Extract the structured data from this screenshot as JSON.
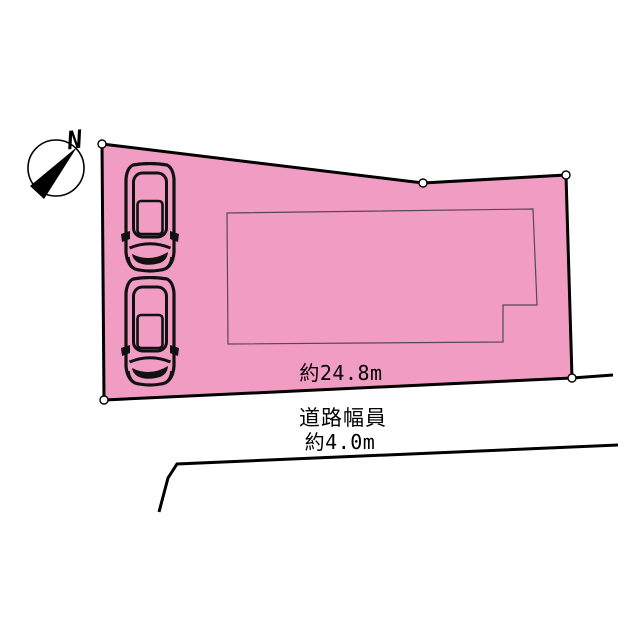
{
  "diagram": {
    "type": "real-estate-site-plan",
    "background_color": "#ffffff",
    "compass": {
      "label": "N"
    },
    "parcel": {
      "fill_color": "#f19cc3",
      "stroke_color": "#000000",
      "stroke_width": 3,
      "vertices": [
        [
          102,
          144
        ],
        [
          423,
          183
        ],
        [
          566,
          175
        ],
        [
          572,
          378
        ],
        [
          104,
          400
        ]
      ],
      "vertex_marker": {
        "radius": 4,
        "fill": "#ffffff",
        "stroke": "#000000"
      },
      "frontage_label": "約24.8m"
    },
    "building_outline": {
      "stroke_color": "#5a4750",
      "stroke_width": 1.2,
      "vertices": [
        [
          227,
          213
        ],
        [
          533,
          209
        ],
        [
          537,
          305
        ],
        [
          503,
          305
        ],
        [
          503,
          342
        ],
        [
          228,
          344
        ]
      ]
    },
    "road": {
      "label_line1": "道路幅員",
      "label_line2": "約4.0m",
      "near_edge_extension": [
        [
          572,
          378
        ],
        [
          613,
          375
        ]
      ],
      "far_edge": [
        [
          159,
          512
        ],
        [
          168,
          478
        ],
        [
          177,
          464
        ],
        [
          618,
          445
        ]
      ],
      "stroke_color": "#000000",
      "stroke_width": 3
    },
    "cars": {
      "count": 2,
      "positions": [
        [
          120,
          162
        ],
        [
          120,
          276
        ]
      ],
      "size": [
        60,
        112
      ]
    }
  }
}
